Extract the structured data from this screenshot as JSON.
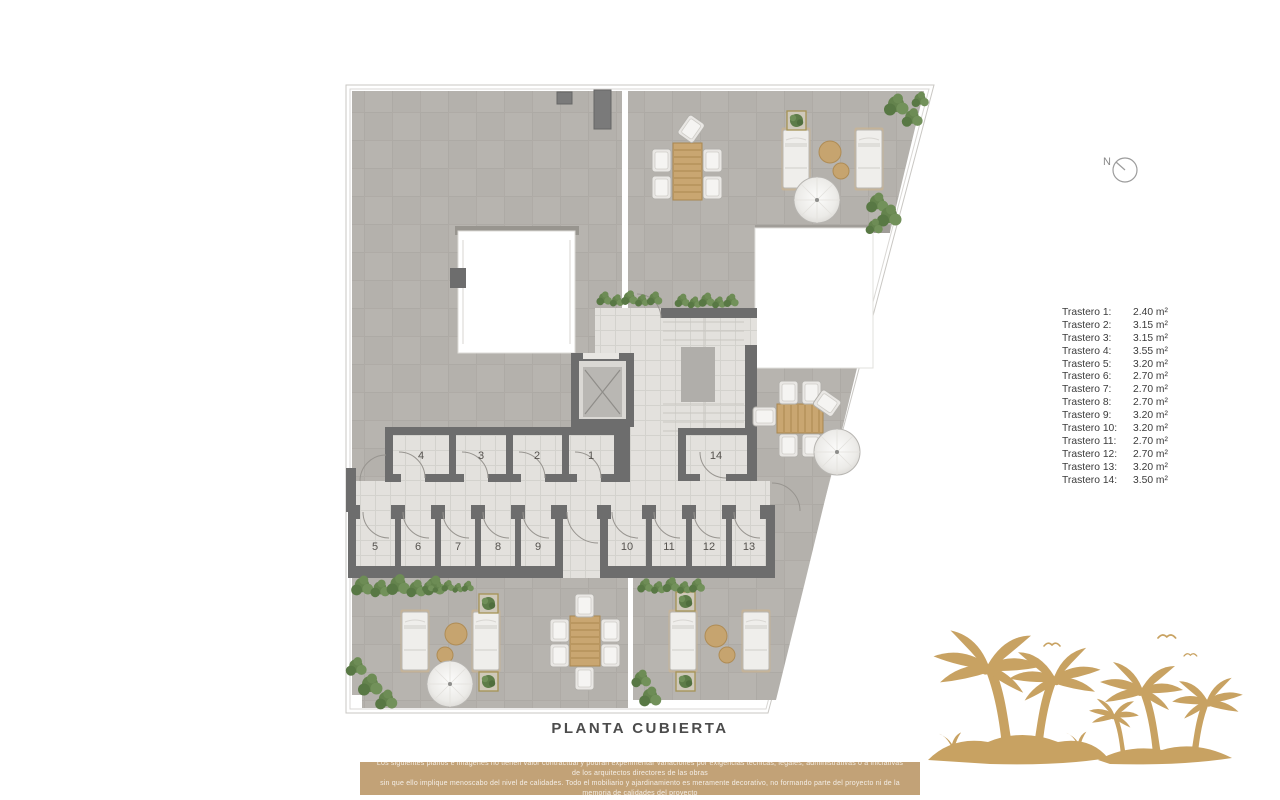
{
  "meta": {
    "title": "PLANTA CUBIERTA"
  },
  "compass": {
    "label": "N"
  },
  "legend": {
    "items": [
      {
        "label": "Trastero 1:",
        "value": "2.40 m²"
      },
      {
        "label": "Trastero 2:",
        "value": "3.15 m²"
      },
      {
        "label": "Trastero 3:",
        "value": "3.15 m²"
      },
      {
        "label": "Trastero 4:",
        "value": "3.55 m²"
      },
      {
        "label": "Trastero 5:",
        "value": "3.20 m²"
      },
      {
        "label": "Trastero 6:",
        "value": "2.70 m²"
      },
      {
        "label": "Trastero 7:",
        "value": "2.70 m²"
      },
      {
        "label": "Trastero 8:",
        "value": "2.70 m²"
      },
      {
        "label": "Trastero 9:",
        "value": "3.20 m²"
      },
      {
        "label": "Trastero 10:",
        "value": "3.20 m²"
      },
      {
        "label": "Trastero 11:",
        "value": "2.70 m²"
      },
      {
        "label": "Trastero 12:",
        "value": "2.70 m²"
      },
      {
        "label": "Trastero 13:",
        "value": "3.20 m²"
      },
      {
        "label": "Trastero 14:",
        "value": "3.50 m²"
      }
    ]
  },
  "plan": {
    "room_labels": [
      "1",
      "2",
      "3",
      "4",
      "5",
      "6",
      "7",
      "8",
      "9",
      "10",
      "11",
      "12",
      "13",
      "14"
    ]
  },
  "footer": {
    "line1": "Los siguientes planos e imágenes no tienen valor contractual y podrán experimentar variaciones por exigencias técnicas, legales, administrativas o a iniciativas de los arquitectos directores de las obras",
    "line2": "sin que ello implique menoscabo del nivel de calidades. Todo el mobiliario y ajardinamiento es meramente decorativo, no formando parte del proyecto ni de la memoria de calidades del proyecto"
  },
  "colors": {
    "terrace_gray": "#b4b1ac",
    "tile_light": "#e3e1dd",
    "wall_dark": "#6d6d6d",
    "accent_gold": "#c2a277",
    "palm_gold": "#c8a262",
    "greenery": "#5e7f49"
  }
}
